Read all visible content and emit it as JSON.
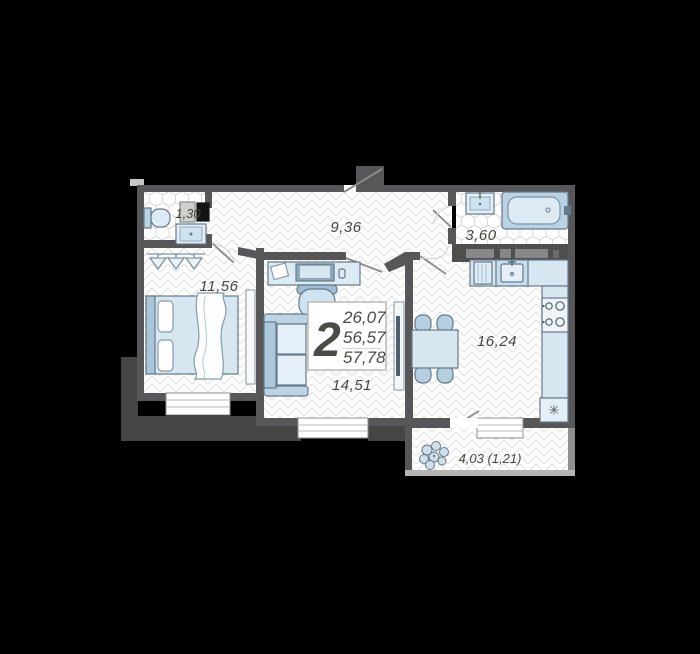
{
  "unit_summary": {
    "rooms_count": "2",
    "areas": [
      "26,07",
      "56,57",
      "57,78"
    ]
  },
  "room_areas": {
    "wc": "1,30",
    "hallway": "9,36",
    "bathroom": "3,60",
    "bedroom": "11,56",
    "living_room": "14,51",
    "kitchen": "16,24",
    "balcony": "4,03 (1,21)"
  },
  "icons": {
    "fridge_symbol": "✳"
  },
  "colors": {
    "background": "#000000",
    "wall": "#57575a",
    "outer_mass": "#454543",
    "furniture_fill": "#d7e7f2",
    "furniture_stroke": "#64798a",
    "floor_line": "#e2e2e0",
    "text": "#46463f"
  }
}
